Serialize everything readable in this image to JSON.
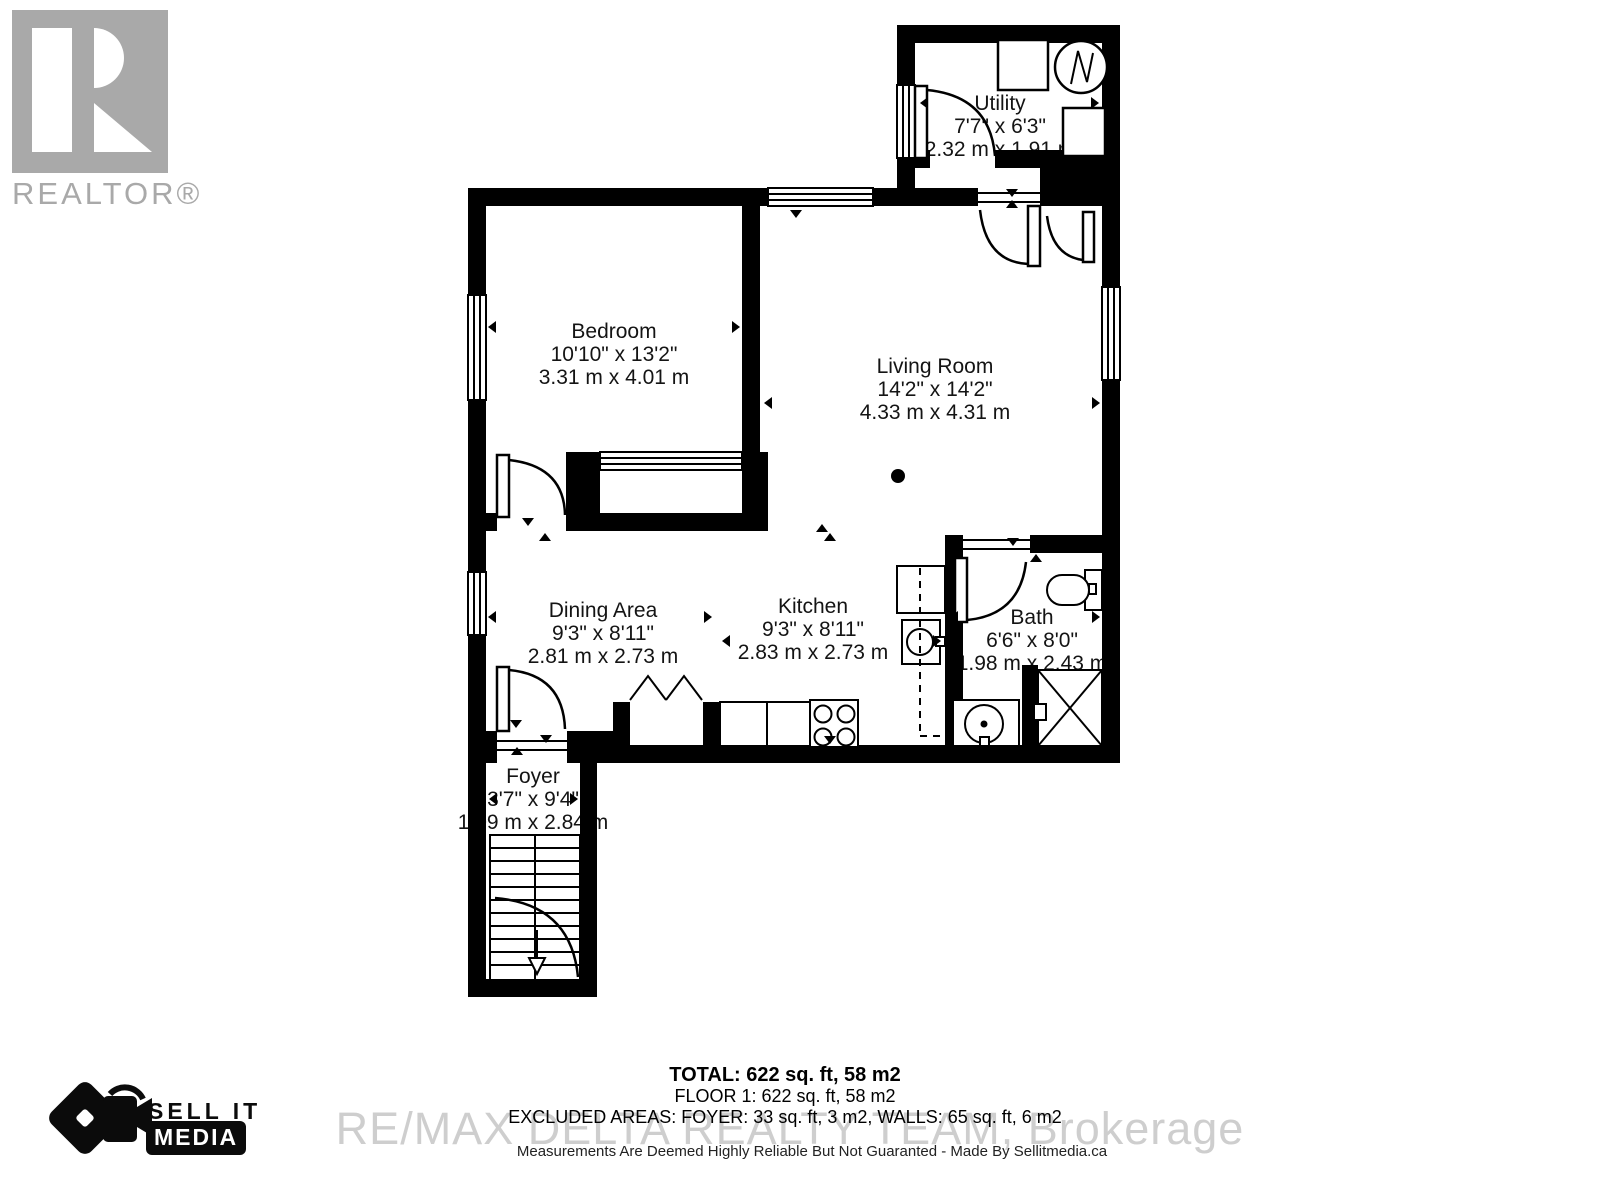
{
  "branding": {
    "realtor_label": "REALTOR®",
    "sellit_line1": "SELL IT",
    "sellit_line2": "MEDIA"
  },
  "rooms": {
    "utility": {
      "name": "Utility",
      "ft": "7'7\" x 6'3\"",
      "m": "2.32 m x 1.91 m"
    },
    "bedroom": {
      "name": "Bedroom",
      "ft": "10'10\" x 13'2\"",
      "m": "3.31 m x 4.01 m"
    },
    "living": {
      "name": "Living Room",
      "ft": "14'2\" x 14'2\"",
      "m": "4.33 m x 4.31 m"
    },
    "dining": {
      "name": "Dining Area",
      "ft": "9'3\" x 8'11\"",
      "m": "2.81 m x 2.73 m"
    },
    "kitchen": {
      "name": "Kitchen",
      "ft": "9'3\" x 8'11\"",
      "m": "2.83 m x 2.73 m"
    },
    "bath": {
      "name": "Bath",
      "ft": "6'6\" x 8'0\"",
      "m": "1.98 m x 2.43 m"
    },
    "foyer": {
      "name": "Foyer",
      "ft": "3'7\" x 9'4\"",
      "m": "1.09 m x 2.84 m"
    }
  },
  "summary": {
    "total": "TOTAL: 622 sq. ft, 58 m2",
    "floor1": "FLOOR 1: 622 sq. ft, 58 m2",
    "excluded": "EXCLUDED AREAS: FOYER: 33 sq. ft, 3 m2, WALLS: 65 sq. ft, 6 m2"
  },
  "watermark": "RE/MAX DELTA REALTY TEAM, Brokerage",
  "disclaimer": "Measurements Are Deemed Highly Reliable But Not Guaranted - Made By Sellitmedia.ca",
  "colors": {
    "wall": "#000000",
    "logo_gray": "#a9a9a9",
    "watermark_gray": "#c3c3c3"
  }
}
